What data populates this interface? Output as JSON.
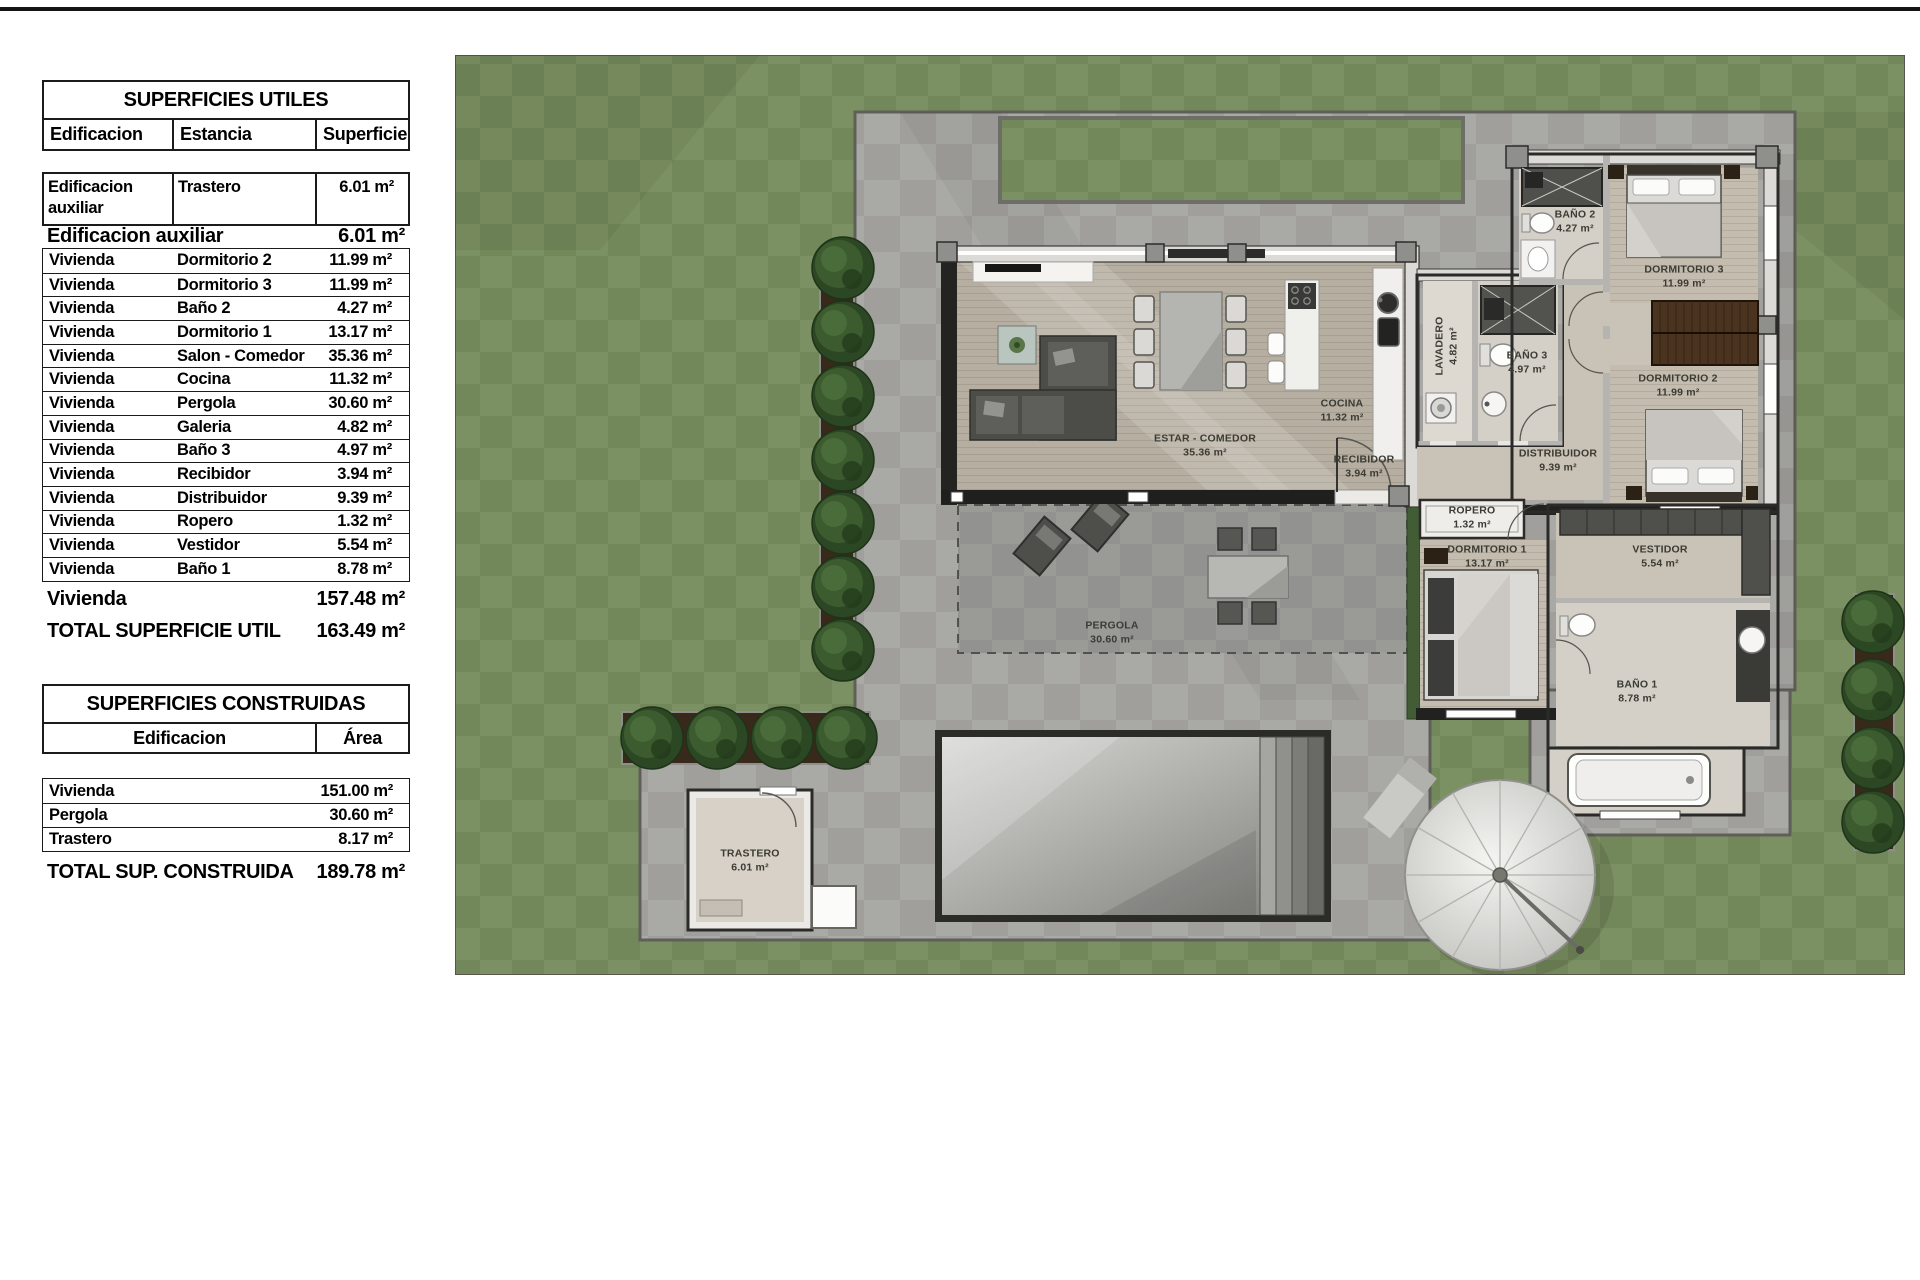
{
  "page": {
    "top_rule_color": "#141414",
    "background": "#ffffff"
  },
  "tables": {
    "utiles": {
      "title": "SUPERFICIES UTILES",
      "columns": [
        "Edificacion",
        "Estancia",
        "Superficie"
      ],
      "aux_row": {
        "edificacion": "Edificacion auxiliar",
        "estancia": "Trastero",
        "superficie": "6.01 m²"
      },
      "aux_summary": {
        "label": "Edificacion auxiliar",
        "value": "6.01 m²"
      },
      "rows": [
        {
          "edificacion": "Vivienda",
          "estancia": "Dormitorio 2",
          "superficie": "11.99 m²"
        },
        {
          "edificacion": "Vivienda",
          "estancia": "Dormitorio 3",
          "superficie": "11.99 m²"
        },
        {
          "edificacion": "Vivienda",
          "estancia": "Baño 2",
          "superficie": "4.27 m²"
        },
        {
          "edificacion": "Vivienda",
          "estancia": "Dormitorio 1",
          "superficie": "13.17 m²"
        },
        {
          "edificacion": "Vivienda",
          "estancia": "Salon - Comedor",
          "superficie": "35.36 m²"
        },
        {
          "edificacion": "Vivienda",
          "estancia": "Cocina",
          "superficie": "11.32 m²"
        },
        {
          "edificacion": "Vivienda",
          "estancia": "Pergola",
          "superficie": "30.60 m²"
        },
        {
          "edificacion": "Vivienda",
          "estancia": "Galeria",
          "superficie": "4.82 m²"
        },
        {
          "edificacion": "Vivienda",
          "estancia": "Baño 3",
          "superficie": "4.97 m²"
        },
        {
          "edificacion": "Vivienda",
          "estancia": "Recibidor",
          "superficie": "3.94 m²"
        },
        {
          "edificacion": "Vivienda",
          "estancia": "Distribuidor",
          "superficie": "9.39 m²"
        },
        {
          "edificacion": "Vivienda",
          "estancia": "Ropero",
          "superficie": "1.32 m²"
        },
        {
          "edificacion": "Vivienda",
          "estancia": "Vestidor",
          "superficie": "5.54 m²"
        },
        {
          "edificacion": "Vivienda",
          "estancia": "Baño 1",
          "superficie": "8.78 m²"
        }
      ],
      "vivienda_summary": {
        "label": "Vivienda",
        "value": "157.48 m²"
      },
      "total": {
        "label": "TOTAL SUPERFICIE UTIL",
        "value": "163.49 m²"
      }
    },
    "construidas": {
      "title": "SUPERFICIES CONSTRUIDAS",
      "columns": [
        "Edificacion",
        "Área"
      ],
      "rows": [
        {
          "edificacion": "Vivienda",
          "area": "151.00 m²"
        },
        {
          "edificacion": "Pergola",
          "area": "30.60 m²"
        },
        {
          "edificacion": "Trastero",
          "area": "8.17 m²"
        }
      ],
      "total": {
        "label": "TOTAL SUP. CONSTRUIDA",
        "value": "189.78 m²"
      }
    }
  },
  "plan": {
    "colors": {
      "grass_light": "#7c9163",
      "grass_dark": "#72875a",
      "terrace_light": "#a9a9a5",
      "terrace_dark": "#a09f9b",
      "pergola_slab": "#99999  5",
      "wall_dark": "#20201e",
      "wood_floor": "#b6aea1",
      "wardrobe_brown": "#4a3420",
      "tree_green": "#2c4724",
      "pool_dark_rim": "#2b2b28"
    },
    "labels": [
      {
        "id": "estar-comedor",
        "name": "ESTAR - COMEDOR",
        "area": "35.36 m²",
        "x": 1205,
        "y": 446
      },
      {
        "id": "cocina",
        "name": "COCINA",
        "area": "11.32 m²",
        "x": 1342,
        "y": 411
      },
      {
        "id": "recibidor",
        "name": "RECIBIDOR",
        "area": "3.94 m²",
        "x": 1364,
        "y": 467
      },
      {
        "id": "distribuidor",
        "name": "DISTRIBUIDOR",
        "area": "9.39 m²",
        "x": 1558,
        "y": 461
      },
      {
        "id": "ropero",
        "name": "ROPERO",
        "area": "1.32 m²",
        "x": 1472,
        "y": 518
      },
      {
        "id": "dormitorio-1",
        "name": "DORMITORIO 1",
        "area": "13.17 m²",
        "x": 1487,
        "y": 557
      },
      {
        "id": "lavadero",
        "name": "LAVADERO",
        "area": "4.82 m²",
        "x": 1447,
        "y": 346,
        "rot": -90
      },
      {
        "id": "bano-3",
        "name": "BAÑO 3",
        "area": "4.97 m²",
        "x": 1527,
        "y": 363
      },
      {
        "id": "bano-2",
        "name": "BAÑO 2",
        "area": "4.27 m²",
        "x": 1575,
        "y": 222
      },
      {
        "id": "dormitorio-3",
        "name": "DORMITORIO 3",
        "area": "11.99 m²",
        "x": 1684,
        "y": 277
      },
      {
        "id": "dormitorio-2",
        "name": "DORMITORIO 2",
        "area": "11.99 m²",
        "x": 1678,
        "y": 386
      },
      {
        "id": "vestidor",
        "name": "VESTIDOR",
        "area": "5.54 m²",
        "x": 1660,
        "y": 557
      },
      {
        "id": "bano-1",
        "name": "BAÑO 1",
        "area": "8.78 m²",
        "x": 1637,
        "y": 692
      },
      {
        "id": "pergola",
        "name": "PERGOLA",
        "area": "30.60 m²",
        "x": 1112,
        "y": 633
      },
      {
        "id": "trastero",
        "name": "TRASTERO",
        "area": "6.01 m²",
        "x": 750,
        "y": 861
      }
    ]
  }
}
